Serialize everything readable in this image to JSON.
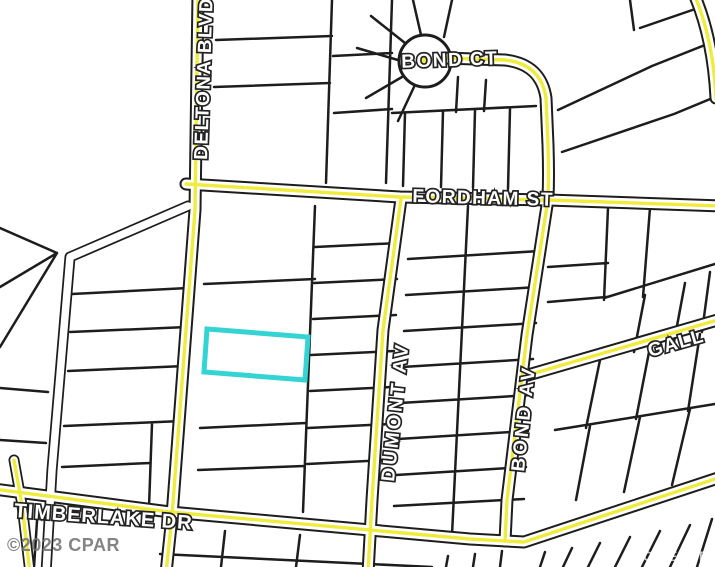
{
  "map": {
    "type": "parcel-plat-map",
    "streets": [
      {
        "id": "deltona-blvd",
        "label": "DELTONA BLVD"
      },
      {
        "id": "bond-ct",
        "label": "BOND CT"
      },
      {
        "id": "fordham-st",
        "label": "FORDHAM ST"
      },
      {
        "id": "dumont-av",
        "label": "DUMONT AV"
      },
      {
        "id": "bond-av",
        "label": "BOND AV"
      },
      {
        "id": "gall-partial",
        "label": "GALL"
      },
      {
        "id": "timberlake-dr",
        "label": "TIMBERLAKE DR"
      }
    ],
    "colors": {
      "background": "#ffffff",
      "parcel_line": "#1d1d1d",
      "road_casing": "#1d1d1d",
      "road_fill": "#ffffff",
      "road_center": "#efec3f",
      "highlight": "#35d4d4",
      "watermark_left": "#6f6f6f",
      "watermark_right": "#ffffff"
    },
    "highlighted_parcel": {
      "outline": "#35d4d4"
    },
    "watermark_left": "©2023 CPAR",
    "watermark_right": "POWERED B"
  }
}
